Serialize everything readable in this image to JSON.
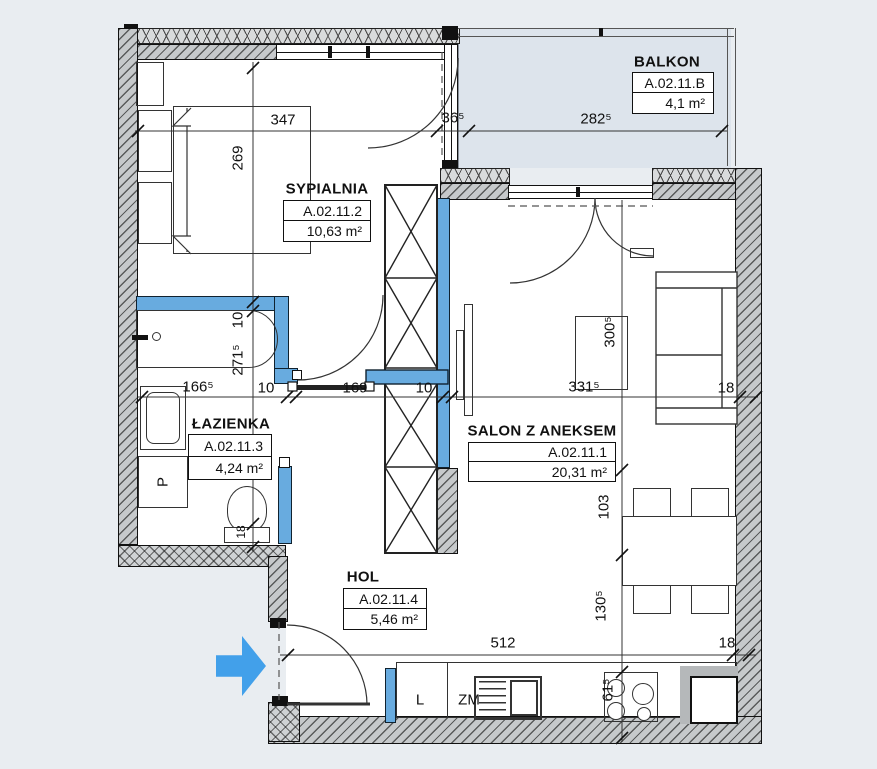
{
  "drawing_type": "apartment floor plan",
  "rooms": [
    {
      "name": "SYPIALNIA",
      "code": "A.02.11.2",
      "area": "10,63 m²"
    },
    {
      "name": "BALKON",
      "code": "A.02.11.B",
      "area": "4,1 m²"
    },
    {
      "name": "ŁAZIENKA",
      "code": "A.02.11.3",
      "area": "4,24 m²"
    },
    {
      "name": "SALON Z ANEKSEM",
      "code": "A.02.11.1",
      "area": "20,31 m²"
    },
    {
      "name": "HOL",
      "code": "A.02.11.4",
      "area": "5,46 m²"
    }
  ],
  "dims": {
    "top_347": "347",
    "top_36_5": "36⁵",
    "balcony_282_5": "282⁵",
    "bedroom_269": "269",
    "mid_166_5": "166⁵",
    "mid_10_left": "10",
    "mid_169": "169",
    "mid_10_right": "10",
    "mid_331_5": "331⁵",
    "mid_18": "18",
    "bath_10": "10",
    "bath_271_5": "271⁵",
    "bath_18": "18",
    "salon_300_5": "300⁵",
    "salon_103": "103",
    "salon_130_5": "130⁵",
    "kitchen_61_5": "61⁵",
    "bottom_512": "512",
    "bottom_18": "18"
  },
  "fixtures": {
    "fridge": "L",
    "dishwasher": "ZM",
    "washing_machine": "P"
  },
  "icons": {
    "entrance_arrow": "entrance-direction-arrow"
  },
  "colors": {
    "background": "#e9edf1",
    "installation_wall_blue": "#68abdf",
    "entrance_arrow_blue": "#42a0ea",
    "wall_gray": "#c6c9cb",
    "balcony_fill": "#dde4ec"
  }
}
